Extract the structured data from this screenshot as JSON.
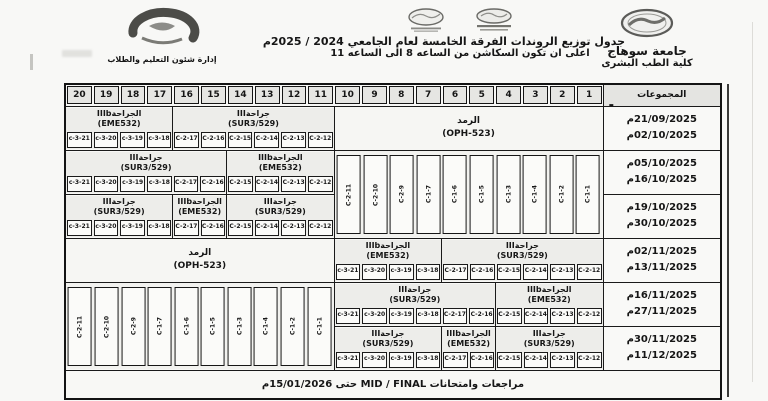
{
  "header": {
    "university": "جامعة سوهاج",
    "faculty": "كلية الطب البشرى",
    "department": "إدارة شئون التعليم والطلاب",
    "title_line1": "جدول توزيع الروندات  الفرقة الخامسة  لعام الجامعي 2024 / 2025م",
    "title_line2": "اعلى ان تكون السكاشن من الساعه 8 الى الساعه 11"
  },
  "courses": {
    "surgery": {
      "title": "جراحةIII",
      "code": "(SUR3/529)"
    },
    "surgery_b": {
      "title": "الجراحةIIIb",
      "code": "(EME532)"
    },
    "ophthalmology": {
      "title": "الرمد",
      "code": "(OPH-523)"
    }
  },
  "codes": {
    "c2_12_17": [
      "C-2-12",
      "C-2-13",
      "C-2-14",
      "C-2-15",
      "C-2-16",
      "C-2-17"
    ],
    "c2_12_15": [
      "C-2-12",
      "C-2-13",
      "C-2-14",
      "C-2-15"
    ],
    "c2_16_17": [
      "C-2-16",
      "C-2-17"
    ],
    "c3_18_21": [
      "c-3-18",
      "c-3-19",
      "c-3-20",
      "c-3-21"
    ],
    "mix_16_21": [
      "C-2-16",
      "C-2-17",
      "c-3-18",
      "c-3-19",
      "c-3-20",
      "c-3-21"
    ],
    "clinics": [
      "C-1-1",
      "C-1-2",
      "C-1-4",
      "C-1-3",
      "C-1-5",
      "C-1-6",
      "C-1-7",
      "C-2-9",
      "C-2-10",
      "C-2-11"
    ]
  },
  "table": {
    "groups_label": "المجموعات",
    "columns": [
      "1",
      "2",
      "3",
      "4",
      "5",
      "6",
      "7",
      "8",
      "9",
      "10",
      "11",
      "12",
      "13",
      "14",
      "15",
      "16",
      "17",
      "18",
      "19",
      "20"
    ],
    "rows": [
      {
        "from": "21/09/2025م",
        "to": "02/10/2025م"
      },
      {
        "from": "05/10/2025م",
        "to": "16/10/2025م"
      },
      {
        "from": "19/10/2025م",
        "to": "30/10/2025م"
      },
      {
        "from": "02/11/2025م",
        "to": "13/11/2025م"
      },
      {
        "from": "16/11/2025م",
        "to": "27/11/2025م"
      },
      {
        "from": "30/11/2025م",
        "to": "11/12/2025م"
      }
    ],
    "exams_note": "مراجعات وامتحانات  MID / FINAL  حتى 15/01/2026م",
    "stray_mark": "-"
  }
}
